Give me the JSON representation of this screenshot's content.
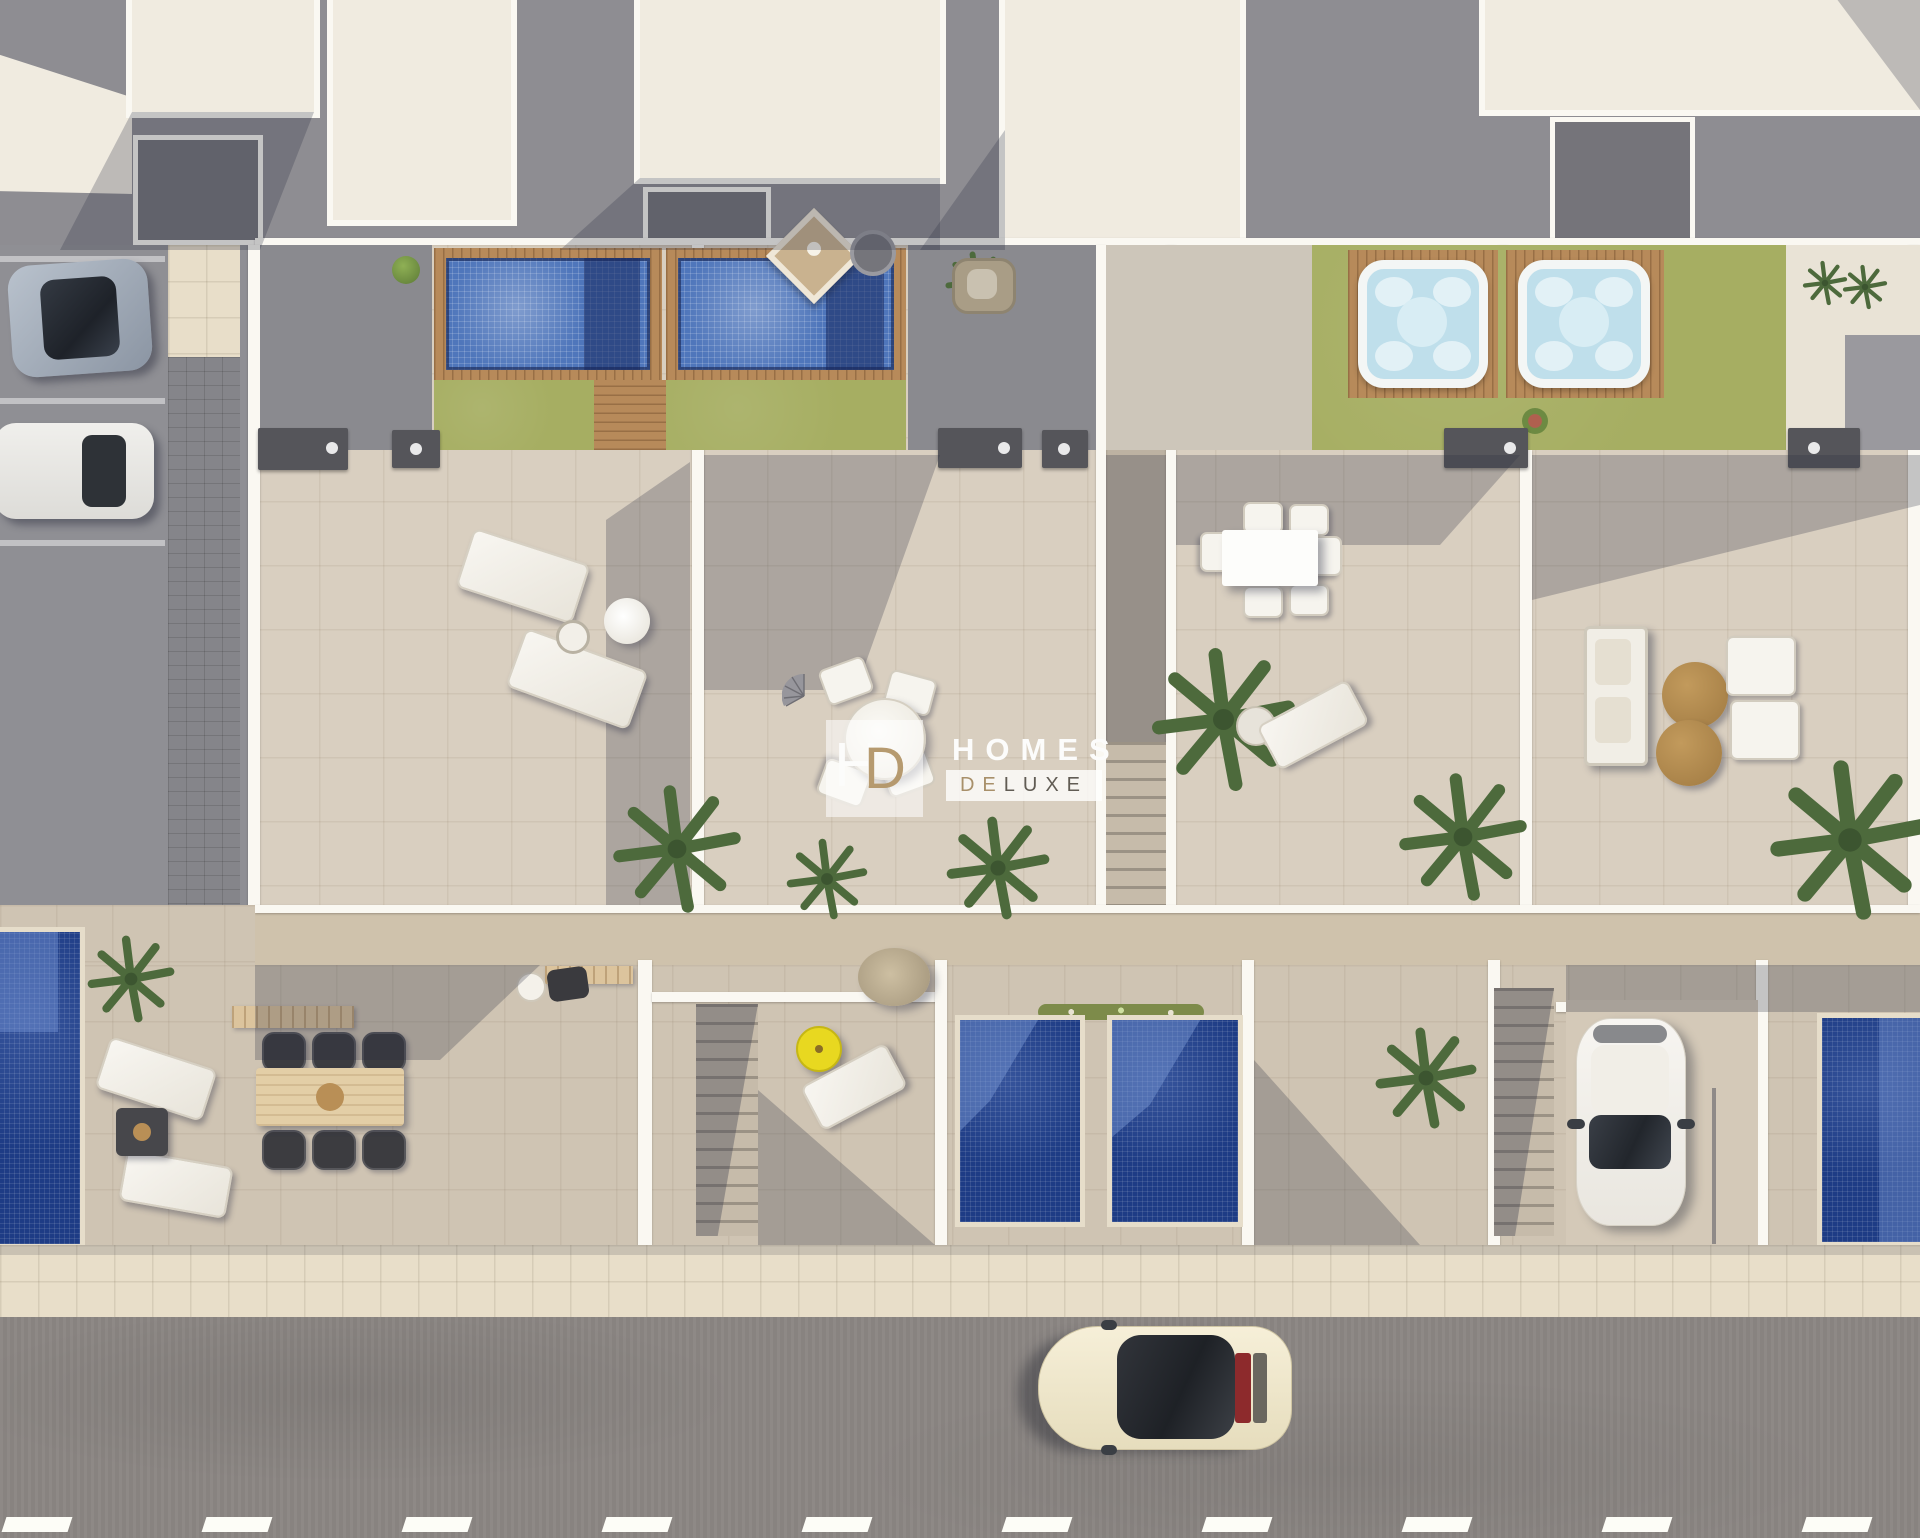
{
  "watermark": {
    "monogram_h": "H",
    "monogram_d": "D",
    "line1": "HOMES",
    "line2_part1": "DE",
    "line2_part2": "LUXE"
  },
  "scene_inventory": {
    "rooftop_pools": 2,
    "jacuzzis": 2,
    "ground_floor_pools": 4,
    "parked_cars_left": 2,
    "driveway_car": 1,
    "street_car": 1,
    "lane_markings": 10
  },
  "palette": {
    "roofGray": "#8e8d92",
    "roofCream": "#f0ebe0",
    "parapet": "#faf8f2",
    "courtyard": "#75747a",
    "terrace": "#d9cfc0",
    "lowerPatio": "#cfc4b3",
    "facade": "#cfc2ac",
    "lawn": "#a6ae62",
    "deckWood": "#b78a5a",
    "pergola": "#dcc49d",
    "poolTile": "#4f76bb",
    "poolLedge": "#2b4a94",
    "poolDark": "#1e3c85",
    "poolCoping": "#e6ddca",
    "jacuzziWater": "#bfdfeb",
    "asphalt": "#8f8f94",
    "street": "#8c8784",
    "sidewalk": "#e8dec9",
    "umbrellaYellow": "#e8d820",
    "carRed": "#8d2a2c",
    "wmWhite": "#fcfcfb",
    "wmTan": "#a8906a",
    "wmDark": "#615c54",
    "wmBoxA": "rgba(255,255,255,0.55)",
    "wmBoxB": "rgba(255,255,255,0.78)"
  }
}
